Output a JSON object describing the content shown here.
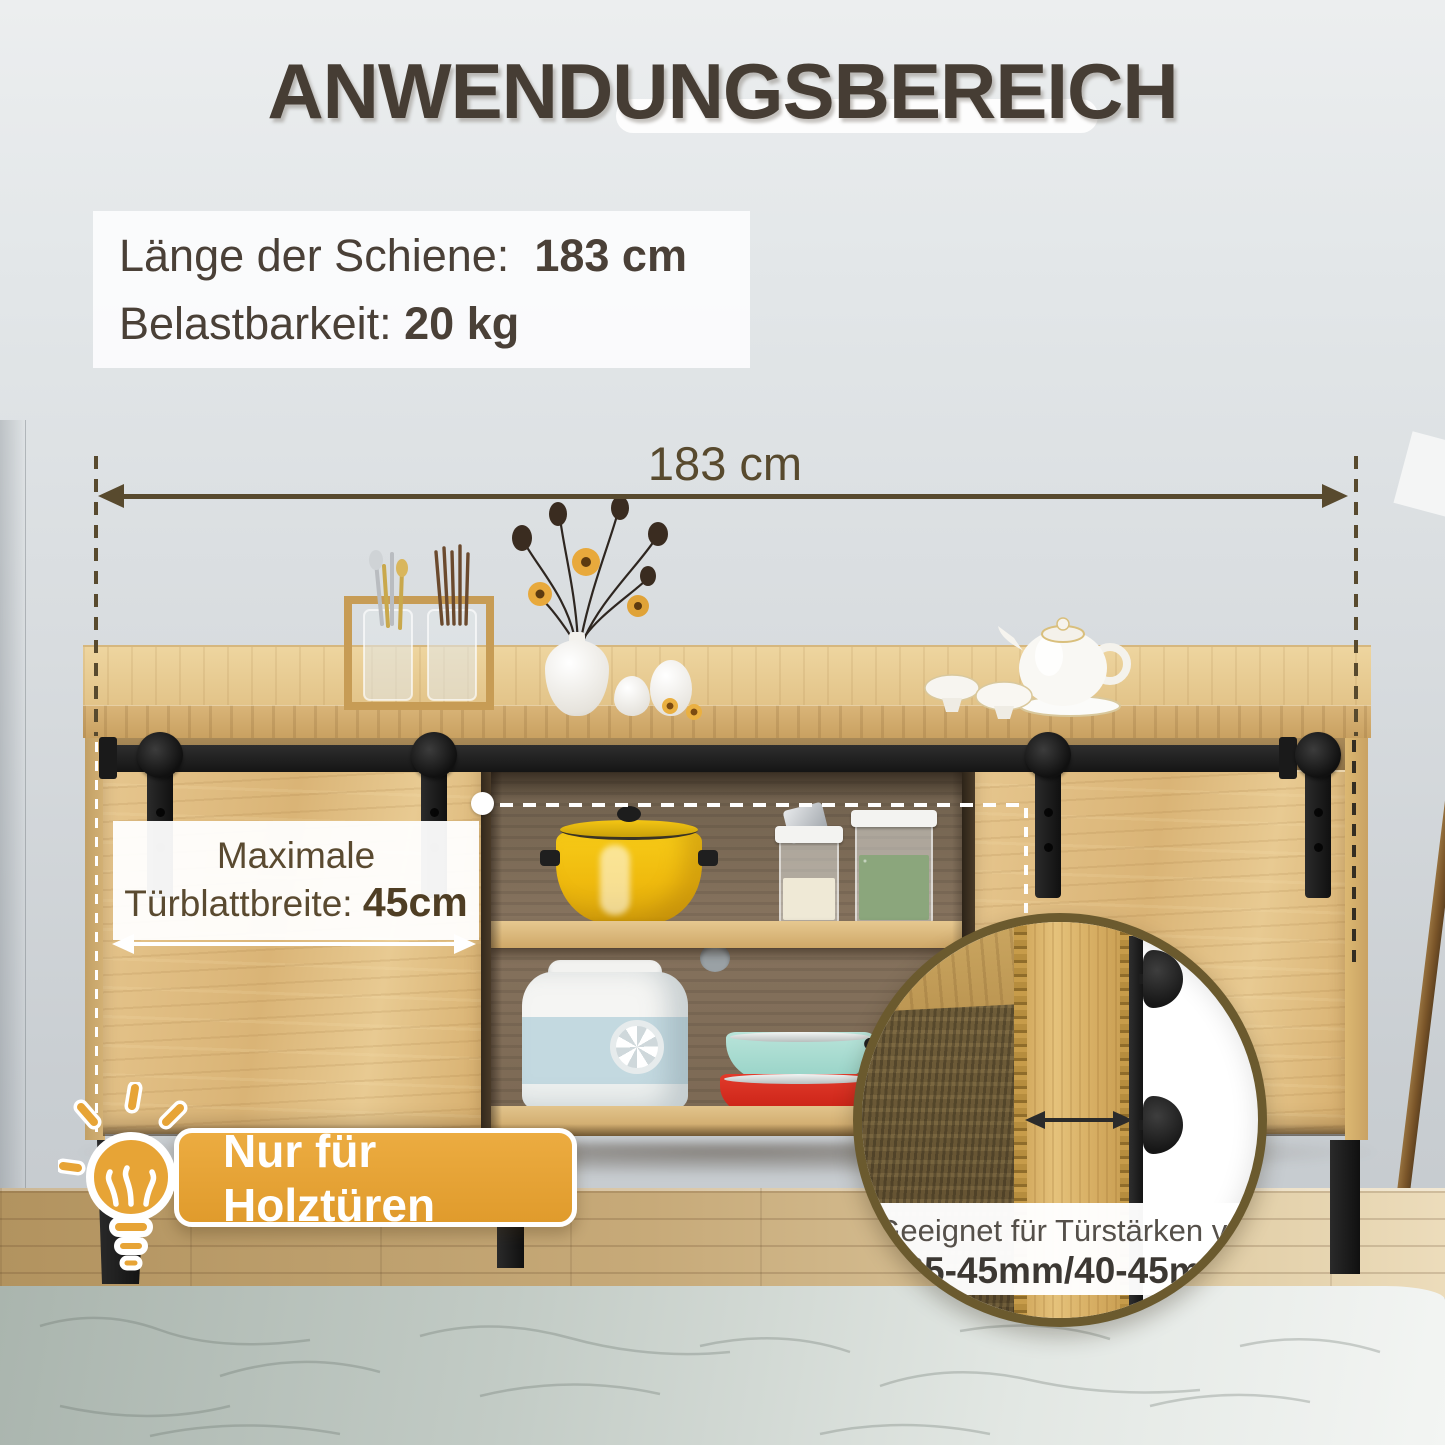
{
  "page": {
    "title": "ANWENDUNGSBEREICH"
  },
  "info_box": {
    "line1_label": "Länge der Schiene:",
    "line1_value": "183 cm",
    "line2_label": "Belastbarkeit:",
    "line2_value": "20 kg"
  },
  "dimension": {
    "label": "183 cm"
  },
  "door_label": {
    "line1": "Maximale",
    "line2_label": "Türblattbreite:",
    "line2_value": "45cm"
  },
  "badge": {
    "label": "Nur für Holztüren"
  },
  "inset": {
    "line1": "Geeignet für Türstärken von",
    "line2": "35-45mm/40-45mm"
  },
  "icons": {
    "lightbulb": "lightbulb-icon",
    "width_arrows": "double-headed-arrow",
    "guides": "dashed-guide-lines"
  },
  "colors": {
    "accent_orange": "#E5A33C",
    "annotation_brown": "#584A2E",
    "title_brown": "#463D34",
    "inset_border": "#6B5A2E",
    "pot_yellow": "#F2C414"
  }
}
